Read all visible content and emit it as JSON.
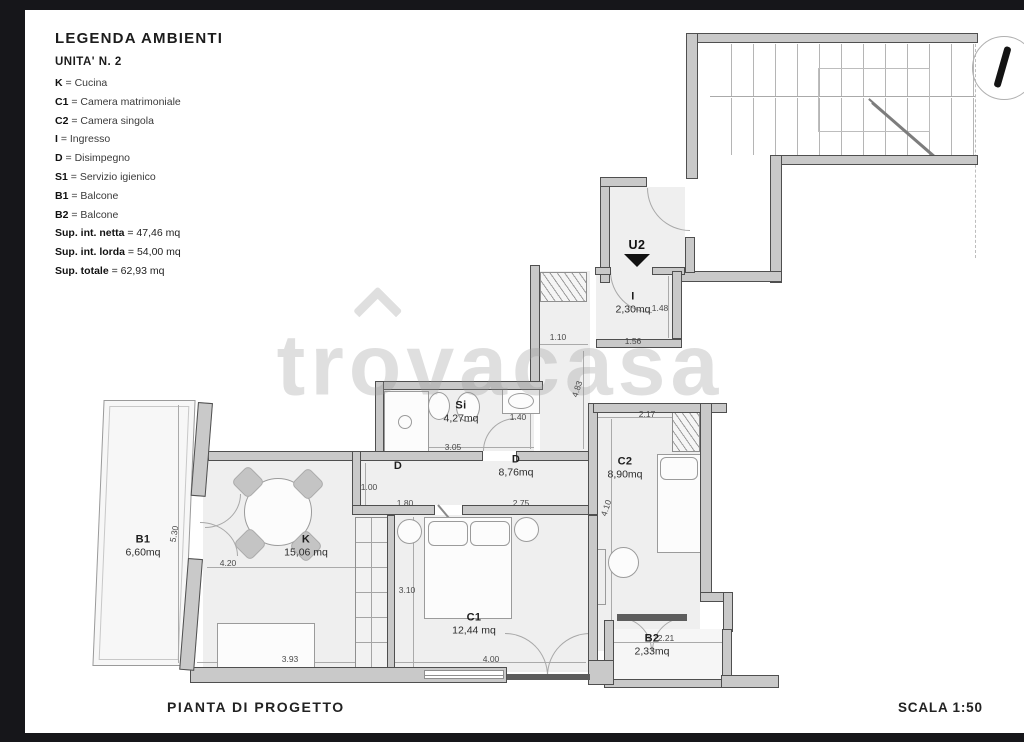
{
  "page": {
    "plan_title": "PIANTA DI PROGETTO",
    "scale_label": "SCALA 1:50",
    "watermark": {
      "part1": "tr",
      "part2": "o",
      "part3": "vacasa"
    }
  },
  "legend": {
    "title": "LEGENDA AMBIENTI",
    "unit": "UNITA' N. 2",
    "separator": "=",
    "entries": [
      {
        "key": "K",
        "value": "Cucina"
      },
      {
        "key": "C1",
        "value": "Camera matrimoniale"
      },
      {
        "key": "C2",
        "value": "Camera singola"
      },
      {
        "key": "I",
        "value": "Ingresso"
      },
      {
        "key": "D",
        "value": "Disimpegno"
      },
      {
        "key": "S1",
        "value": "Servizio igienico"
      },
      {
        "key": "B1",
        "value": "Balcone"
      },
      {
        "key": "B2",
        "value": "Balcone"
      }
    ],
    "totals": [
      {
        "key": "Sup. int. netta",
        "value": "47,46 mq"
      },
      {
        "key": "Sup. int. lorda",
        "value": "54,00 mq"
      },
      {
        "key": "Sup. totale",
        "value": "62,93 mq"
      }
    ]
  },
  "plan": {
    "unit_marker": "U2",
    "rooms": [
      {
        "id": "ingresso",
        "label": "I",
        "area": "2,30mq",
        "x": 633,
        "y": 303
      },
      {
        "id": "bagno",
        "label": "Si",
        "area": "4,27mq",
        "x": 461,
        "y": 412
      },
      {
        "id": "disimpegno-1",
        "label": "D",
        "area": "",
        "x": 398,
        "y": 466
      },
      {
        "id": "disimpegno-2",
        "label": "D",
        "area": "8,76mq",
        "x": 516,
        "y": 466
      },
      {
        "id": "cucina",
        "label": "K",
        "area": "15,06 mq",
        "x": 306,
        "y": 546
      },
      {
        "id": "camera-matrimoniale",
        "label": "C1",
        "area": "12,44 mq",
        "x": 474,
        "y": 624
      },
      {
        "id": "camera-singola",
        "label": "C2",
        "area": "8,90mq",
        "x": 625,
        "y": 468
      },
      {
        "id": "balcone-1",
        "label": "B1",
        "area": "6,60mq",
        "x": 143,
        "y": 546
      },
      {
        "id": "balcone-2",
        "label": "B2",
        "area": "2,33mq",
        "x": 652,
        "y": 645
      }
    ],
    "dimensions": [
      {
        "t": "1.10",
        "x": 558,
        "y": 337,
        "r": 0
      },
      {
        "t": "1.56",
        "x": 633,
        "y": 341,
        "r": 0
      },
      {
        "t": "1.48",
        "x": 660,
        "y": 308,
        "r": 0
      },
      {
        "t": "4.83",
        "x": 577,
        "y": 389,
        "r": -72
      },
      {
        "t": "2.17",
        "x": 647,
        "y": 414,
        "r": 0
      },
      {
        "t": "1.40",
        "x": 518,
        "y": 417,
        "r": 0
      },
      {
        "t": "3.05",
        "x": 453,
        "y": 447,
        "r": 0
      },
      {
        "t": "1.00",
        "x": 369,
        "y": 487,
        "r": 0
      },
      {
        "t": "1.80",
        "x": 405,
        "y": 503,
        "r": 0
      },
      {
        "t": "2.75",
        "x": 521,
        "y": 503,
        "r": 0
      },
      {
        "t": "4.10",
        "x": 606,
        "y": 508,
        "r": -72
      },
      {
        "t": "3.10",
        "x": 407,
        "y": 590,
        "r": 0
      },
      {
        "t": "4.00",
        "x": 491,
        "y": 659,
        "r": 0
      },
      {
        "t": "4.20",
        "x": 228,
        "y": 563,
        "r": 0
      },
      {
        "t": "3.93",
        "x": 290,
        "y": 659,
        "r": 0
      },
      {
        "t": "5.30",
        "x": 174,
        "y": 534,
        "r": -80
      },
      {
        "t": "2.21",
        "x": 666,
        "y": 638,
        "r": 0
      }
    ]
  }
}
